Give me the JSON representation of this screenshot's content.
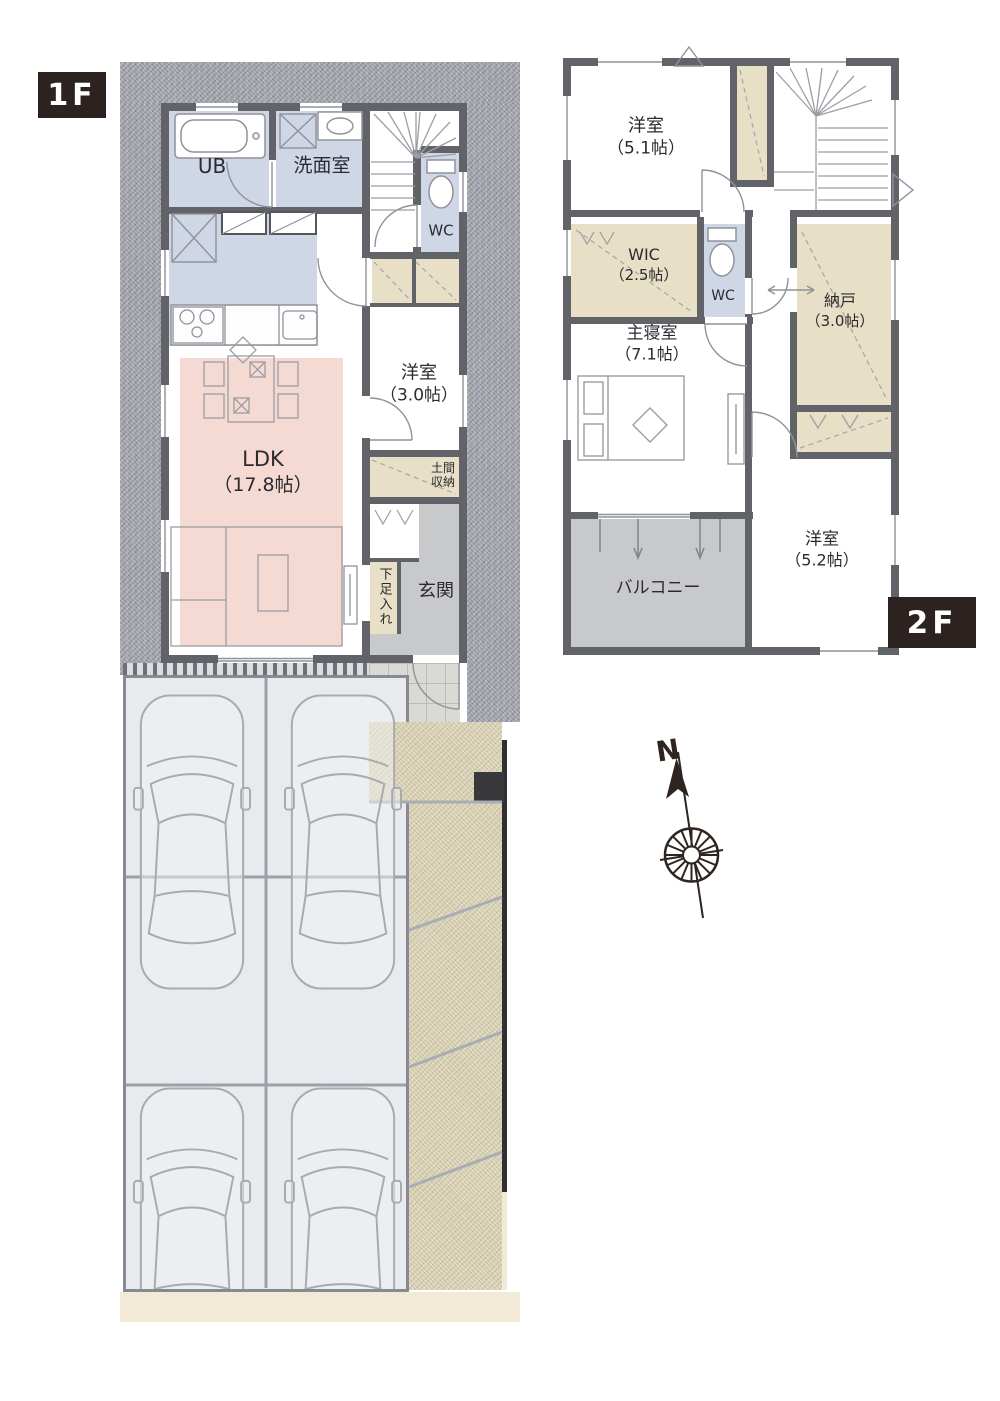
{
  "colors": {
    "wall": "#626369",
    "room_blue": "#cfd7e7",
    "room_pink": "#f5d9d3",
    "room_beige": "#e7dfc6",
    "room_gray": "#c8c9ca",
    "parking": "#e9eaed",
    "gravel": "#a1a3ab",
    "path_beige": "#d8cfb2",
    "tile": "#d9d9d5",
    "cream": "#f2e9d7",
    "tag_bg": "#2c2320",
    "text": "#2b2b2f",
    "compass": "#2e2420"
  },
  "compass": {
    "label": "N"
  },
  "floor1": {
    "tag": "1F",
    "rooms": {
      "ub": {
        "name": "UB"
      },
      "senmen": {
        "name": "洗面室"
      },
      "wc": {
        "name": "WC"
      },
      "yoshitsu": {
        "name": "洋室",
        "size": "（3.0帖）"
      },
      "ldk": {
        "name": "LDK",
        "size": "（17.8帖）"
      },
      "doma": {
        "name1": "土間",
        "name2": "収納"
      },
      "genkan": {
        "name": "玄関"
      },
      "gesokuire": {
        "name": "下足入れ"
      }
    }
  },
  "floor2": {
    "tag": "2F",
    "rooms": {
      "yoshitsu51": {
        "name": "洋室",
        "size": "（5.1帖）"
      },
      "wic": {
        "name": "WIC",
        "size": "（2.5帖）"
      },
      "wc": {
        "name": "WC"
      },
      "nando": {
        "name": "納戸",
        "size": "（3.0帖）"
      },
      "bedroom": {
        "name": "主寝室",
        "size": "（7.1帖）"
      },
      "balcony": {
        "name": "バルコニー"
      },
      "yoshitsu52": {
        "name": "洋室",
        "size": "（5.2帖）"
      }
    }
  }
}
